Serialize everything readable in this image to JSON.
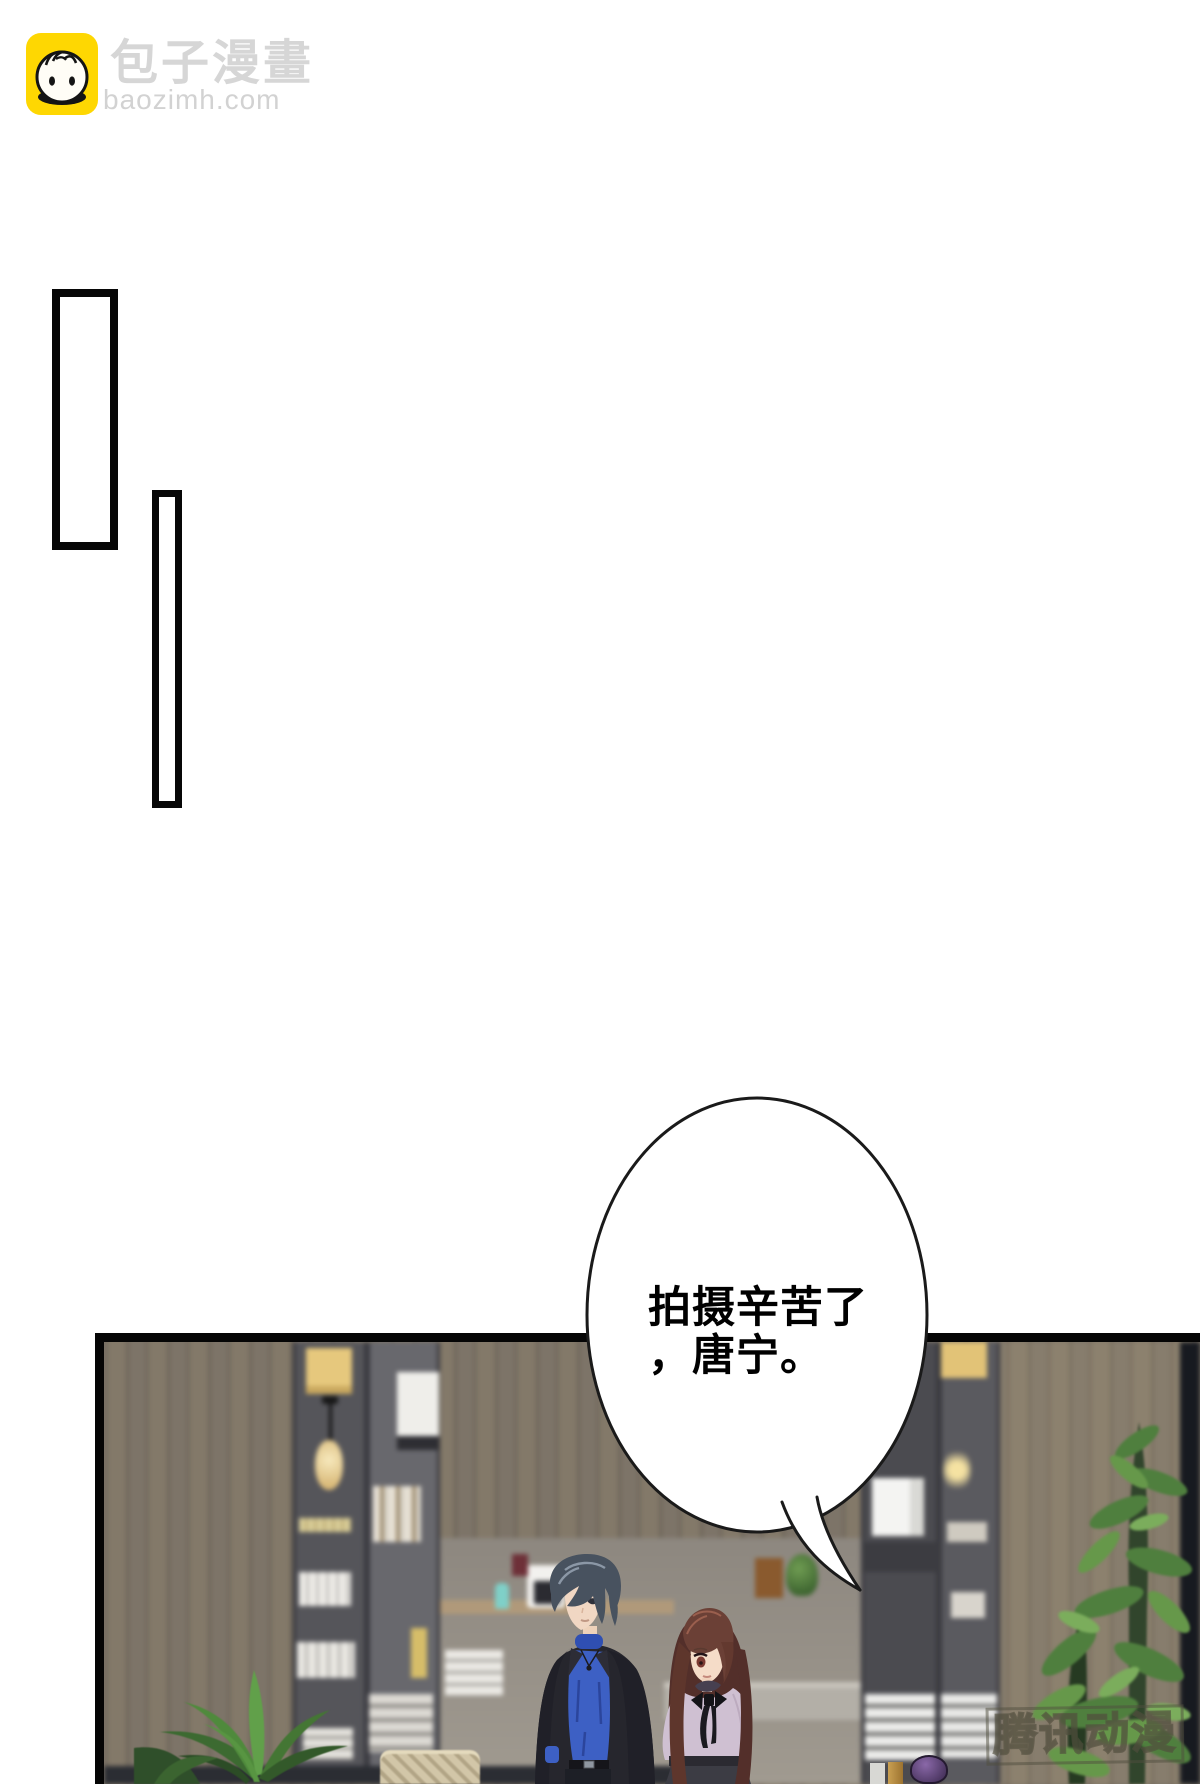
{
  "site_header": {
    "site_name": "包子漫畫",
    "site_domain": "baozimh.com",
    "brand_yellow": "#fed702",
    "header_text_gray": "#d6d6d6"
  },
  "speech_bubble": {
    "full_text": "拍摄辛苦了，唐宁。",
    "line1": "拍摄辛苦了",
    "line2": "，唐宁。",
    "outline_color": "#1a1a1a"
  },
  "watermark": {
    "text": "腾讯动漫",
    "color": "rgba(80,78,62,0.62)"
  }
}
